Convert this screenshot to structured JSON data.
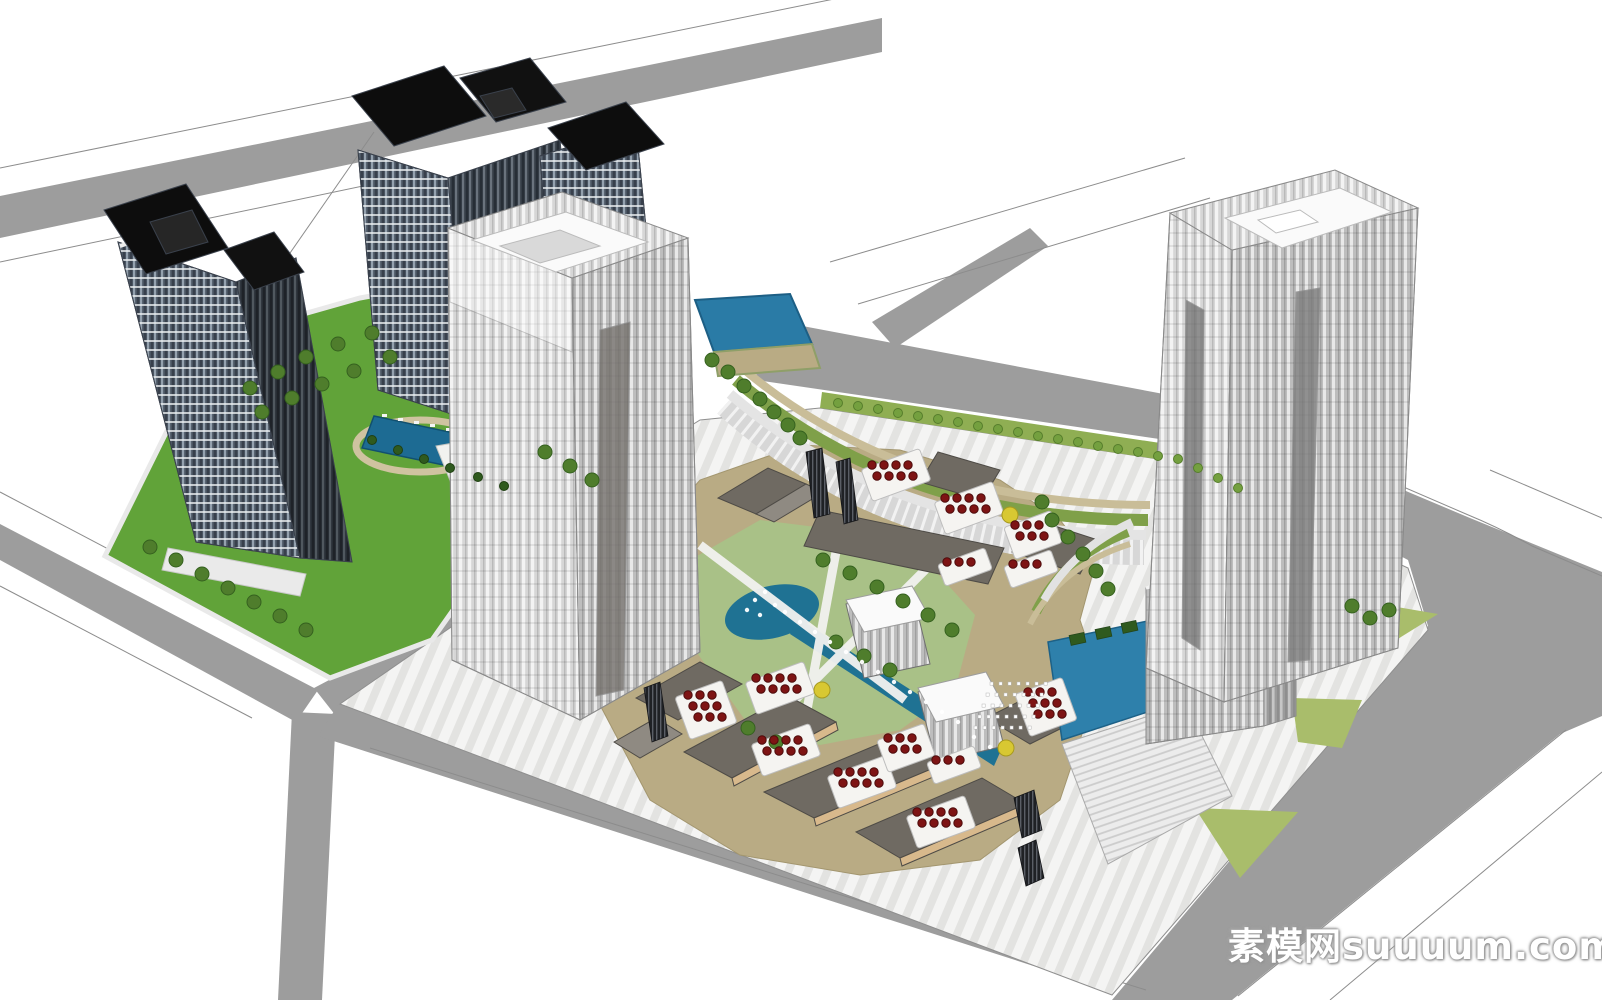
{
  "watermark": {
    "text": "素模网suuuum.com"
  },
  "palette": {
    "ground": "#ffffff",
    "road": "#9d9d9d",
    "curb": "#8c8c8c",
    "lawn_bright": "#61a339",
    "lawn_sage": "#a9c187",
    "lawn_olive": "#a9bd6b",
    "hedge": "#8fae53",
    "water_pool": "#1d6b93",
    "water_pond": "#1f7293",
    "water_plaza": "#2e80ab",
    "plaza_tan": "#b9ab84",
    "roof_dark": "#6f6a62",
    "wood_facade": "#d8b98c",
    "umbrella_red": "#7e1414",
    "tree_green": "#4f7d2c",
    "tree_yellow": "#d8c832",
    "residential_glass": "#4a5562",
    "tower_face_light": "#d6d6d6"
  },
  "scene": {
    "trees": {
      "dark": [
        [
          150,
          547
        ],
        [
          176,
          560
        ],
        [
          202,
          574
        ],
        [
          228,
          588
        ],
        [
          254,
          602
        ],
        [
          280,
          616
        ],
        [
          306,
          630
        ],
        [
          250,
          388
        ],
        [
          278,
          372
        ],
        [
          306,
          357
        ],
        [
          338,
          344
        ],
        [
          372,
          333
        ],
        [
          262,
          412
        ],
        [
          292,
          398
        ],
        [
          322,
          384
        ],
        [
          354,
          371
        ],
        [
          390,
          357
        ],
        [
          545,
          452
        ],
        [
          570,
          466
        ],
        [
          592,
          480
        ],
        [
          823,
          560
        ],
        [
          850,
          573
        ],
        [
          877,
          587
        ],
        [
          903,
          601
        ],
        [
          928,
          615
        ],
        [
          952,
          630
        ],
        [
          836,
          642
        ],
        [
          864,
          656
        ],
        [
          890,
          670
        ],
        [
          748,
          728
        ],
        [
          776,
          742
        ],
        [
          712,
          360
        ],
        [
          728,
          372
        ],
        [
          744,
          386
        ],
        [
          760,
          399
        ],
        [
          774,
          412
        ],
        [
          788,
          425
        ],
        [
          800,
          438
        ],
        [
          1042,
          502
        ],
        [
          1052,
          520
        ],
        [
          1068,
          537
        ],
        [
          1083,
          554
        ],
        [
          1096,
          571
        ],
        [
          1108,
          589
        ],
        [
          1352,
          606
        ],
        [
          1370,
          618
        ],
        [
          1389,
          610
        ]
      ],
      "palm": [
        [
          372,
          440
        ],
        [
          398,
          450
        ],
        [
          424,
          459
        ],
        [
          450,
          468
        ],
        [
          478,
          477
        ],
        [
          504,
          486
        ]
      ],
      "hedge": [
        [
          838,
          403
        ],
        [
          858,
          406
        ],
        [
          878,
          409
        ],
        [
          898,
          413
        ],
        [
          918,
          416
        ],
        [
          938,
          419
        ],
        [
          958,
          422
        ],
        [
          978,
          426
        ],
        [
          998,
          429
        ],
        [
          1018,
          432
        ],
        [
          1038,
          436
        ],
        [
          1058,
          439
        ],
        [
          1078,
          442
        ],
        [
          1098,
          446
        ],
        [
          1118,
          449
        ],
        [
          1138,
          452
        ],
        [
          1158,
          456
        ],
        [
          1178,
          459
        ],
        [
          1198,
          468
        ],
        [
          1218,
          478
        ],
        [
          1238,
          488
        ]
      ],
      "yellow": [
        [
          1010,
          515
        ],
        [
          822,
          690
        ],
        [
          1006,
          748
        ]
      ]
    },
    "umbrella_clusters": [
      {
        "x": 872,
        "y": 465,
        "rows": 2,
        "cols": 4
      },
      {
        "x": 945,
        "y": 498,
        "rows": 2,
        "cols": 4
      },
      {
        "x": 1015,
        "y": 525,
        "rows": 2,
        "cols": 3
      },
      {
        "x": 947,
        "y": 562,
        "rows": 1,
        "cols": 3
      },
      {
        "x": 1013,
        "y": 564,
        "rows": 1,
        "cols": 3
      },
      {
        "x": 688,
        "y": 695,
        "rows": 3,
        "cols": 3
      },
      {
        "x": 756,
        "y": 678,
        "rows": 2,
        "cols": 4
      },
      {
        "x": 762,
        "y": 740,
        "rows": 2,
        "cols": 4
      },
      {
        "x": 838,
        "y": 772,
        "rows": 2,
        "cols": 4
      },
      {
        "x": 888,
        "y": 738,
        "rows": 2,
        "cols": 3
      },
      {
        "x": 936,
        "y": 760,
        "rows": 1,
        "cols": 3
      },
      {
        "x": 917,
        "y": 812,
        "rows": 2,
        "cols": 4
      },
      {
        "x": 1028,
        "y": 692,
        "rows": 3,
        "cols": 3
      }
    ],
    "fountain_jets": [
      [
        755,
        600
      ],
      [
        765,
        592
      ],
      [
        775,
        605
      ],
      [
        747,
        610
      ],
      [
        760,
        615
      ],
      [
        785,
        612
      ],
      [
        800,
        622
      ],
      [
        815,
        632
      ],
      [
        830,
        642
      ],
      [
        846,
        652
      ],
      [
        862,
        662
      ],
      [
        878,
        672
      ],
      [
        894,
        682
      ],
      [
        910,
        692
      ],
      [
        926,
        702
      ],
      [
        942,
        712
      ],
      [
        958,
        722
      ],
      [
        974,
        737
      ],
      [
        990,
        747
      ]
    ],
    "amphitheater": {
      "x": 990,
      "y": 682,
      "rows": 5,
      "cols": 7,
      "stepx": 9,
      "stepy": 11
    }
  }
}
